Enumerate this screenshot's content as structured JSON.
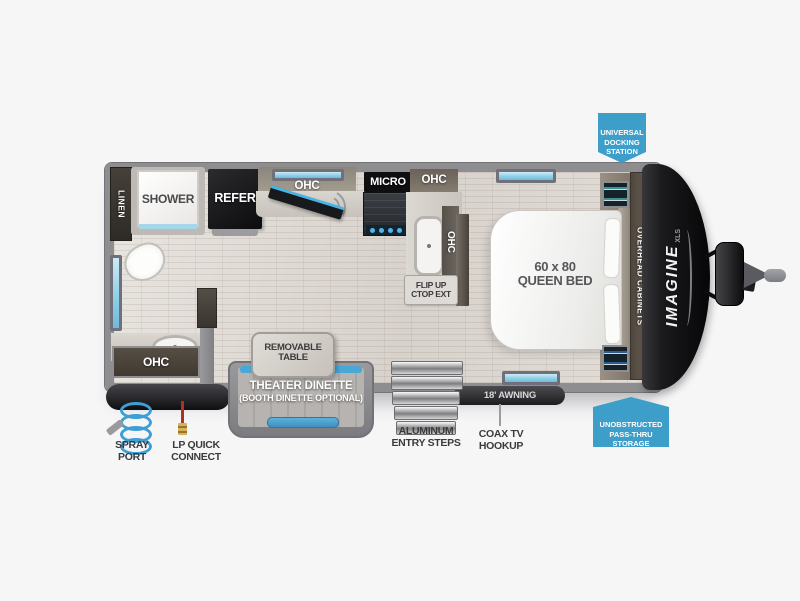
{
  "colors": {
    "callout_blue": "#3d9ec9",
    "window_blue": "#8fd0e8",
    "accent_blue": "#49a8d6",
    "wall_gray": "#8e8e91",
    "cap_black": "#121214"
  },
  "callouts": {
    "docking": "UNIVERSAL\nDOCKING\nSTATION",
    "passthru": "UNOBSTRUCTED\nPASS-THRU\nSTORAGE"
  },
  "interior": {
    "linen": "LINEN",
    "shower": "SHOWER",
    "refer": "REFER",
    "ohc_kitchen": "OHC",
    "micro": "MICRO",
    "ohc_top": "OHC",
    "ohc_side": "OHC",
    "flip_up": "FLIP UP\nCTOP EXT",
    "queen_bed": "60 x 80\nQUEEN BED",
    "overhead_cabinets": "OVERHEAD CABINETS",
    "ohc_bath": "OHC"
  },
  "exterior": {
    "removable_table": "REMOVABLE\nTABLE",
    "theater_dinette": "THEATER DINETTE",
    "booth_optional": "(BOOTH DINETTE OPTIONAL)",
    "entry_steps": "ALUMINUM\nENTRY STEPS",
    "awning": "18' AWNING",
    "coax": "COAX TV\nHOOKUP",
    "spray_port": "SPRAY\nPORT",
    "lp_connect": "LP QUICK\nCONNECT"
  },
  "brand": {
    "name": "IMAGINE",
    "trim": "XLS"
  }
}
